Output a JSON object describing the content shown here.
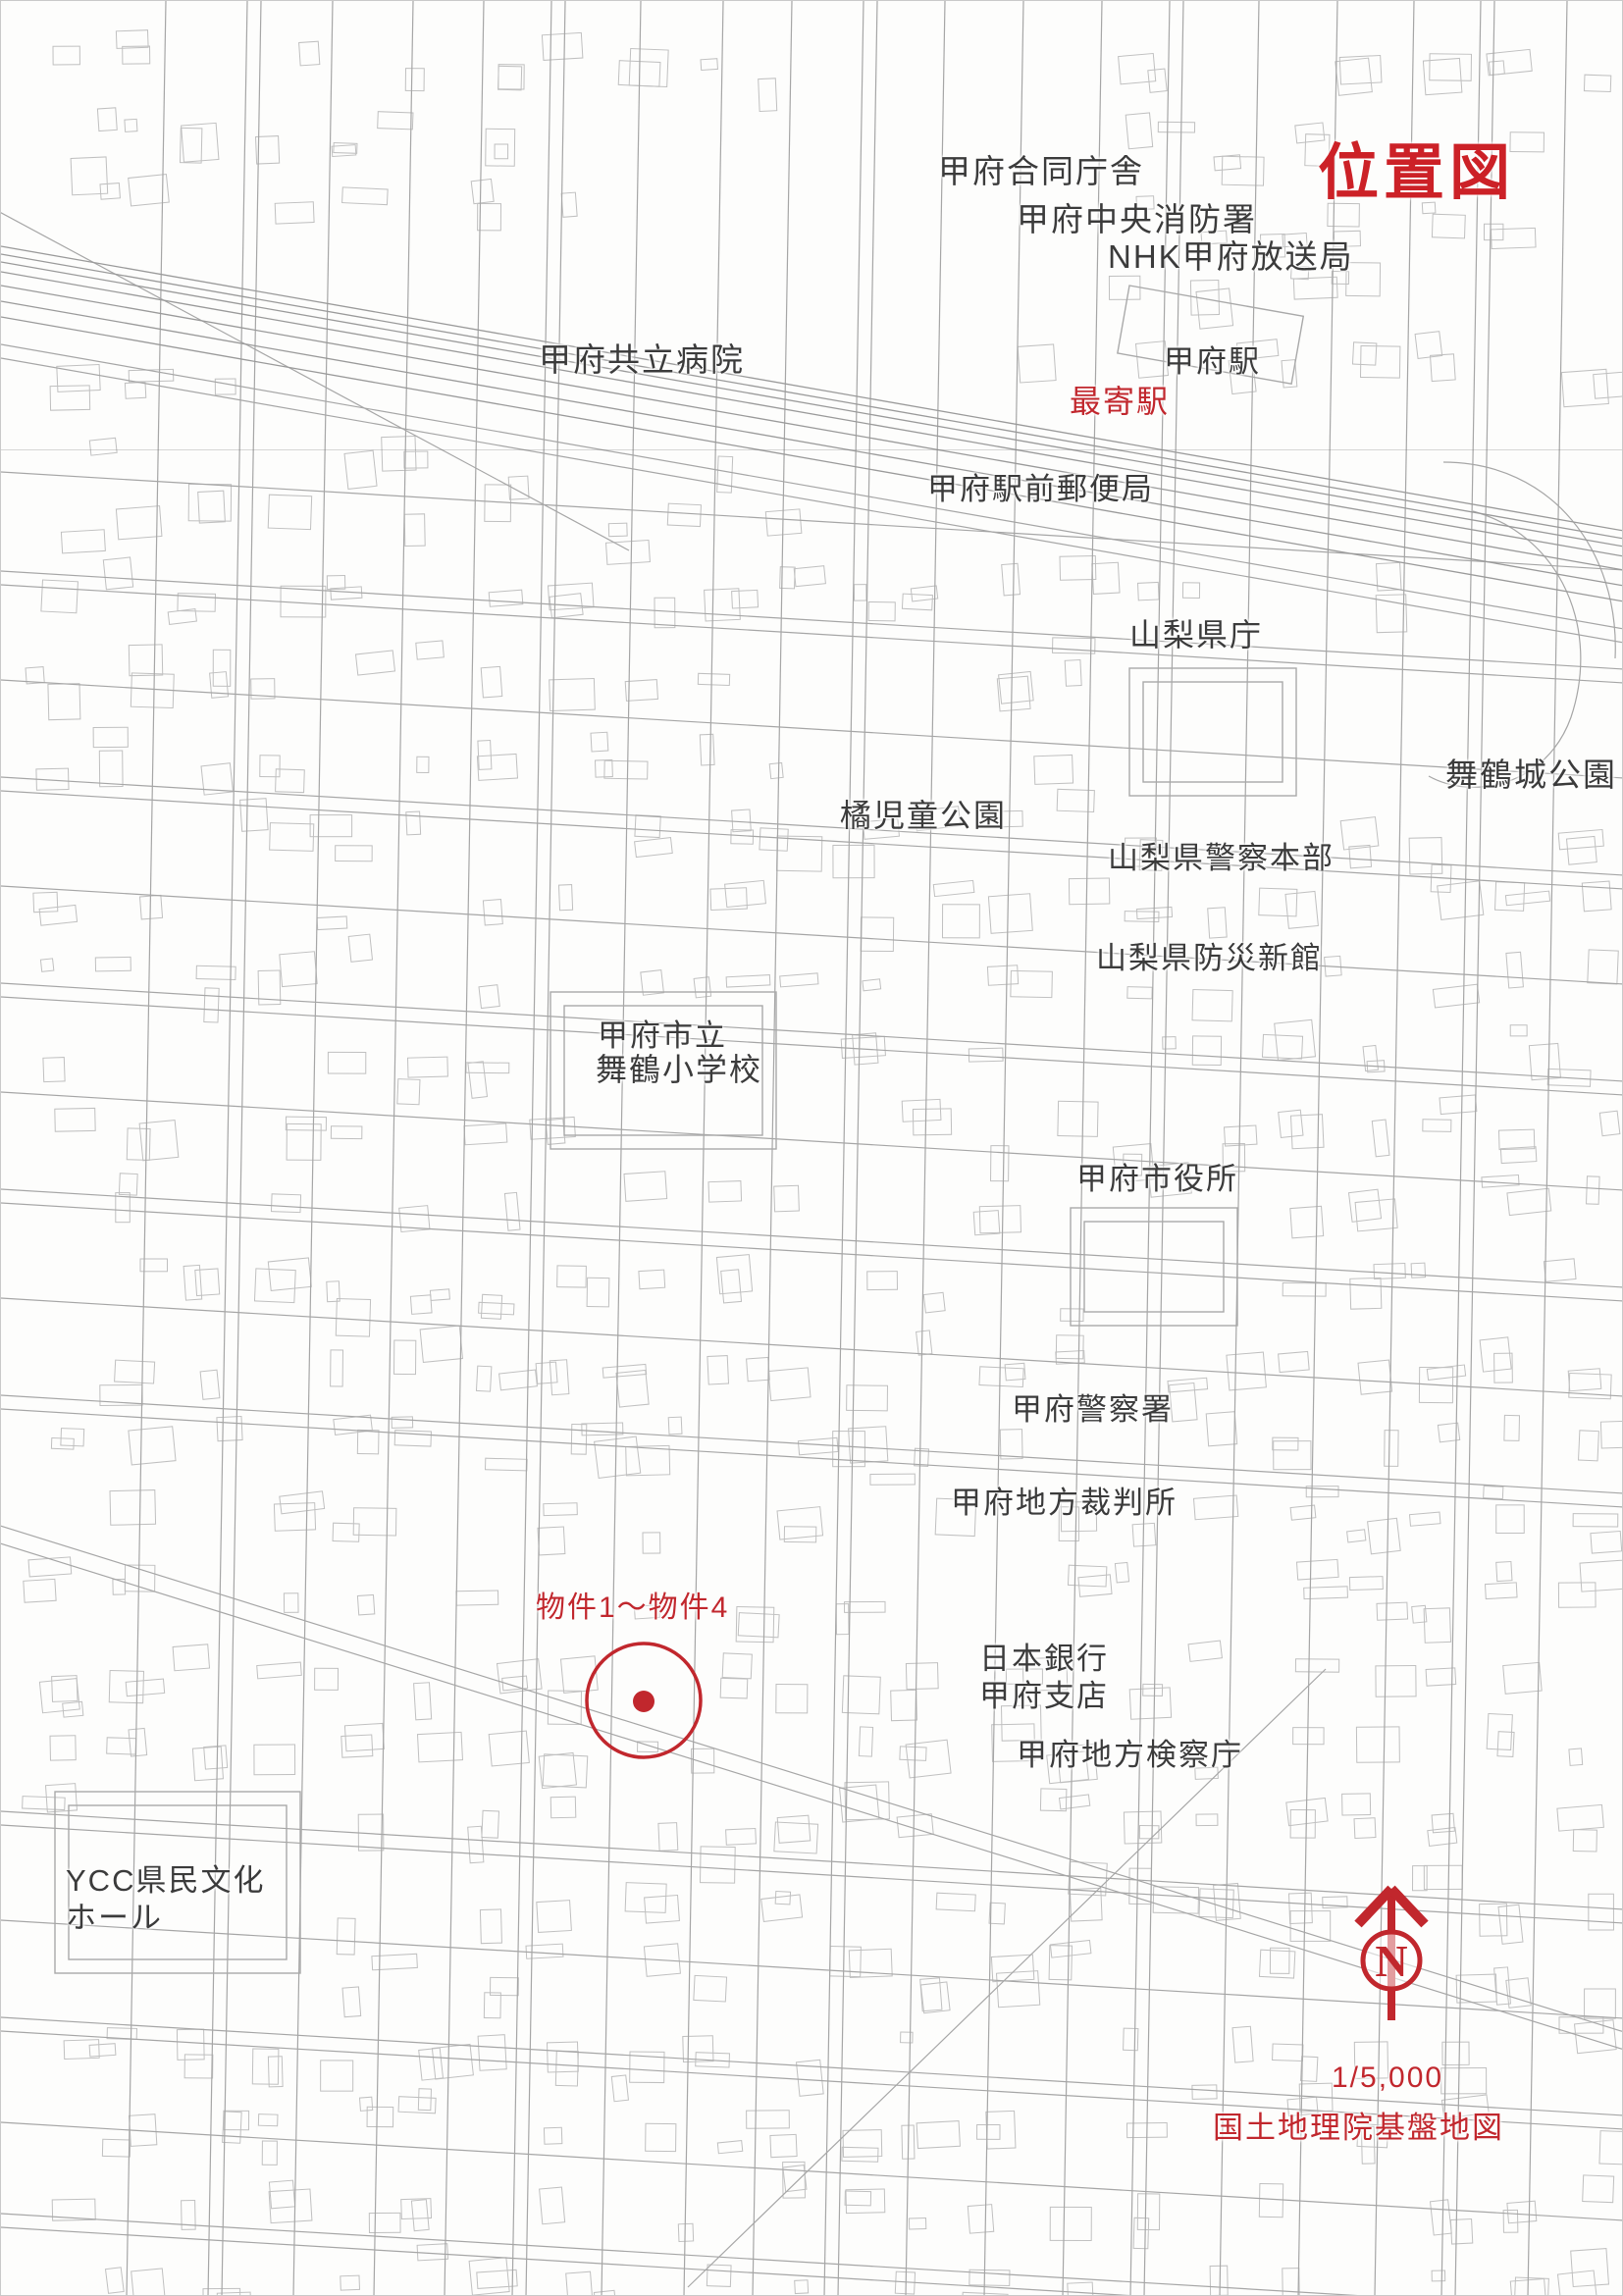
{
  "map": {
    "title": "位置図",
    "scale": "1/5,000",
    "source": "国土地理院基盤地図",
    "compass_letter": "N",
    "colors": {
      "annotation_red": "#c1272d",
      "title_red": "#cc2127",
      "label_ink": "#3b3b3b",
      "map_line_gray": "#b3b3b3"
    },
    "landmarks": {
      "godo_chosha": "甲府合同庁舎",
      "chuo_fire_station": "甲府中央消防署",
      "nhk_kofu": "NHK甲府放送局",
      "kyoritsu_hospital": "甲府共立病院",
      "kofu_station": "甲府駅",
      "station_post_office": "甲府駅前郵便局",
      "pref_office": "山梨県庁",
      "maizuru_castle_park": "舞鶴城公園",
      "tachibana_park": "橘児童公園",
      "pref_police_hq": "山梨県警察本部",
      "pref_bosai_shinkan": "山梨県防災新館",
      "maizuru_elementary_line1": "甲府市立",
      "maizuru_elementary_line2": "舞鶴小学校",
      "city_hall": "甲府市役所",
      "kofu_police": "甲府警察署",
      "district_court": "甲府地方裁判所",
      "bank_of_japan_line1": "日本銀行",
      "bank_of_japan_line2": "甲府支店",
      "district_prosecutors": "甲府地方検察庁",
      "ycc_hall_line1": "YCC県民文化",
      "ycc_hall_line2": "ホール"
    },
    "annotations": {
      "nearest_station": "最寄駅",
      "property_range": "物件1～物件4"
    }
  }
}
